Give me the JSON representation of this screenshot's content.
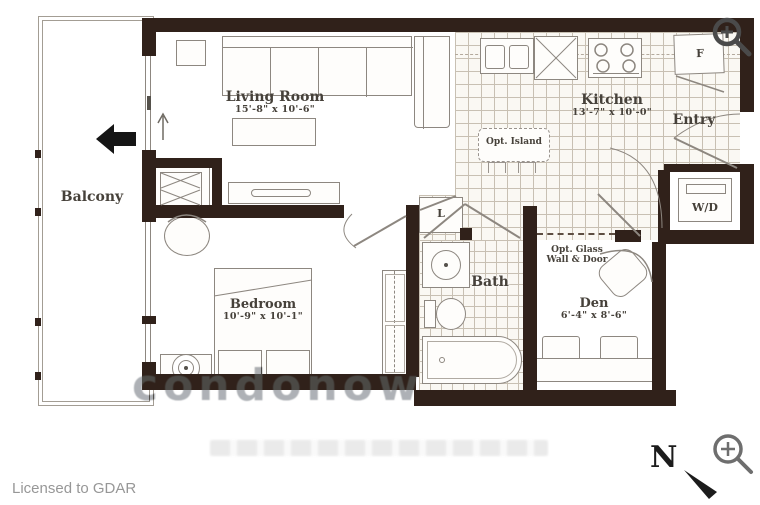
{
  "colors": {
    "wall": "#30211a",
    "furniture_line": "#8d8780",
    "tile_line": "#c8c0b3",
    "label_text": "#46413a",
    "footer_text": "#979797"
  },
  "balcony": {
    "label": "Balcony"
  },
  "living_room": {
    "label": "Living Room",
    "dims": "15'-8\" x 10'-6\""
  },
  "kitchen": {
    "label": "Kitchen",
    "dims": "13'-7\" x 10'-0\"",
    "island_label": "Opt. Island"
  },
  "entry": {
    "label": "Entry",
    "fridge_label": "F"
  },
  "laundry": {
    "label": "W/D"
  },
  "bedroom": {
    "label": "Bedroom",
    "dims": "10'-9\" x 10'-1\""
  },
  "bath": {
    "label": "Bath"
  },
  "den": {
    "label": "Den",
    "dims": "6'-4\" x 8'-6\"",
    "glass_note_line1": "Opt. Glass",
    "glass_note_line2": "Wall & Door"
  },
  "linen_closet": {
    "label": "L"
  },
  "compass": {
    "label": "N"
  },
  "watermark": {
    "large": "condonow"
  },
  "footer": {
    "license": "Licensed to GDAR"
  },
  "icons": {
    "top_right": "zoom-in-icon",
    "bottom_right": "zoom-in-icon"
  }
}
